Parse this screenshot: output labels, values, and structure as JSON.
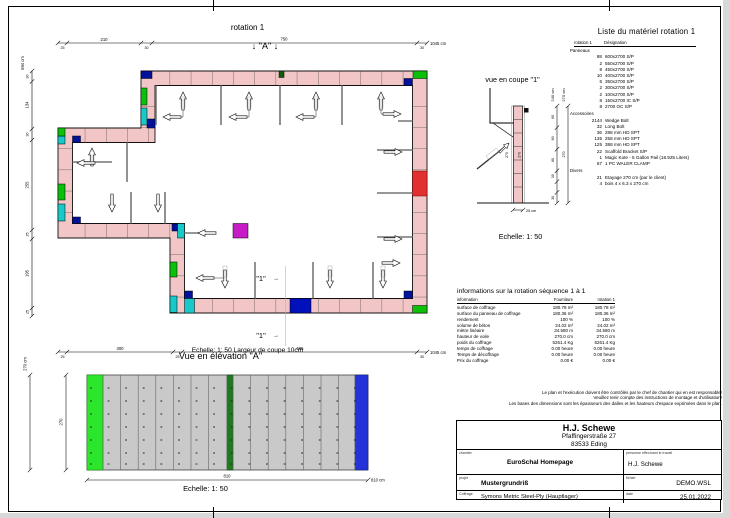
{
  "plan": {
    "title": "rotation 1",
    "marker_a": "↓ \"A\" ↓",
    "marker_1": "\"1\"",
    "marker_arrow": "→",
    "dims": {
      "top": [
        "25",
        "210",
        "30",
        "750",
        "30"
      ],
      "top_total": "1045 cm",
      "bottom": [
        "25",
        "300",
        "25",
        "665",
        "30"
      ],
      "bottom_total": "1045 cm",
      "left": [
        "30",
        "134",
        "30",
        "255",
        "25",
        "195",
        "25"
      ],
      "left_total": "694 cm"
    }
  },
  "coupe": {
    "title": "vue en coupe \"1\"",
    "scale": "Echelle: 1: 50",
    "dims": {
      "col1": [
        "60",
        "60",
        "60",
        "30",
        "30"
      ],
      "col1_total": "240 cm",
      "col2_seg": "270",
      "col2_total": "270 cm",
      "wall_left": "270",
      "wall_right": "270",
      "width": "25 cm"
    }
  },
  "elevation": {
    "title": "Vue en élévation \"A\"",
    "note": "Echelle: 1: 50  Largeur de coupe 10cm",
    "scale": "Echelle: 1: 50",
    "dims": {
      "width": "810",
      "width_total": "810 cm",
      "height": "270",
      "height_total": "270 cm"
    }
  },
  "materials": {
    "title": "Liste du matériel  rotation 1",
    "header_qty": "rotation 1",
    "header_des": "Désignation",
    "sections": [
      {
        "name": "Panneaux",
        "items": [
          {
            "qty": "88",
            "des": "600x2700 S/P"
          },
          {
            "qty": "2",
            "des": "550x2700 S/P"
          },
          {
            "qty": "8",
            "des": "450x2700 S/P"
          },
          {
            "qty": "10",
            "des": "400x2700 S/P"
          },
          {
            "qty": "6",
            "des": "350x2700 S/P"
          },
          {
            "qty": "2",
            "des": "300x2700 S/P"
          },
          {
            "qty": "2",
            "des": "100x2700 S/P"
          },
          {
            "qty": "8",
            "des": "150x2700 IC S/P"
          },
          {
            "qty": "8",
            "des": "2700 OC S/P"
          }
        ]
      },
      {
        "name": "Accessoires",
        "items": [
          {
            "qty": "2144",
            "des": "Wedge Bolt"
          },
          {
            "qty": "32",
            "des": "Long Bolt"
          },
          {
            "qty": "36",
            "des": "288 mm HD SPT"
          },
          {
            "qty": "135",
            "des": "258 mm HD SPT"
          },
          {
            "qty": "125",
            "des": "388 mm HD SPT"
          },
          {
            "qty": "22",
            "des": "Scaffold Bracket S/P"
          },
          {
            "qty": "1",
            "des": "Magic Kote - 5 Gallon Pail (18.925 Liters)"
          },
          {
            "qty": "67",
            "des": "1 PC WALER CLAMP"
          }
        ]
      },
      {
        "name": "Divers",
        "items": [
          {
            "qty": "21",
            "des": "Etayage 270 cm (par le client)"
          },
          {
            "qty": "4",
            "des": "bois 4 x 6.3 x 270 cm"
          }
        ]
      }
    ]
  },
  "info": {
    "title": "informations sur la rotation  séquence 1 à 1",
    "col_info": "information",
    "col_fourniture": "Fourniture",
    "col_rotation": "rotation 1",
    "rows": [
      {
        "label": "surface de coffrage",
        "fourniture": "180.78 m²",
        "rotation": "180.78 m²"
      },
      {
        "label": "surface du panneau de coffrage",
        "fourniture": "180.36 m²",
        "rotation": "180.36 m²"
      },
      {
        "label": "rendement",
        "fourniture": "100 %",
        "rotation": "100 %"
      },
      {
        "label": "volume de béton",
        "fourniture": "24.02 m³",
        "rotation": "24.02 m³"
      },
      {
        "label": "mètre linéaire",
        "fourniture": "34.580 m",
        "rotation": "34.580 m"
      },
      {
        "label": "hauteur de voile",
        "fourniture": "270.0 cm",
        "rotation": "270.0 cm"
      },
      {
        "label": "poids du coffrage",
        "fourniture": "5261.4 Kg",
        "rotation": "5261.4 Kg"
      },
      {
        "label": "temps de coffrage",
        "fourniture": "0.00 heure",
        "rotation": "0.00 heure"
      },
      {
        "label": "Temps de décoffrage",
        "fourniture": "0.00 heure",
        "rotation": "0.00 heure"
      },
      {
        "label": "Prix du coffrage",
        "fourniture": "0.00 €",
        "rotation": "0.00 €"
      }
    ]
  },
  "notes": [
    "Le plan et l'exécution doivent être contrôlés par le chef de chantier qui en est responsable!",
    "Veuillez tenir compte des instructions de montage et d'utilisation!",
    "Les bases des dimensions sont les épaisseurs des dalles et les hauteurs d'espace exprimées dans le plan."
  ],
  "titleblock": {
    "company": "H.J. Schewe",
    "street": "Pfaffingerstraße 27",
    "city": "83533 Eding",
    "label_site": "chantier",
    "site": "EuroSchal Homepage",
    "label_person": "personne effectuant le travail",
    "person": "H.J. Schewe",
    "label_project": "projet",
    "project": "Mustergrundriß",
    "label_file": "fichier",
    "file": "DEMO.WSL",
    "label_formwork": "Coffrage",
    "formwork": "Symons Metric Steel-Ply (Hauptlager)",
    "label_date": "date",
    "date": "25.01.2022"
  }
}
